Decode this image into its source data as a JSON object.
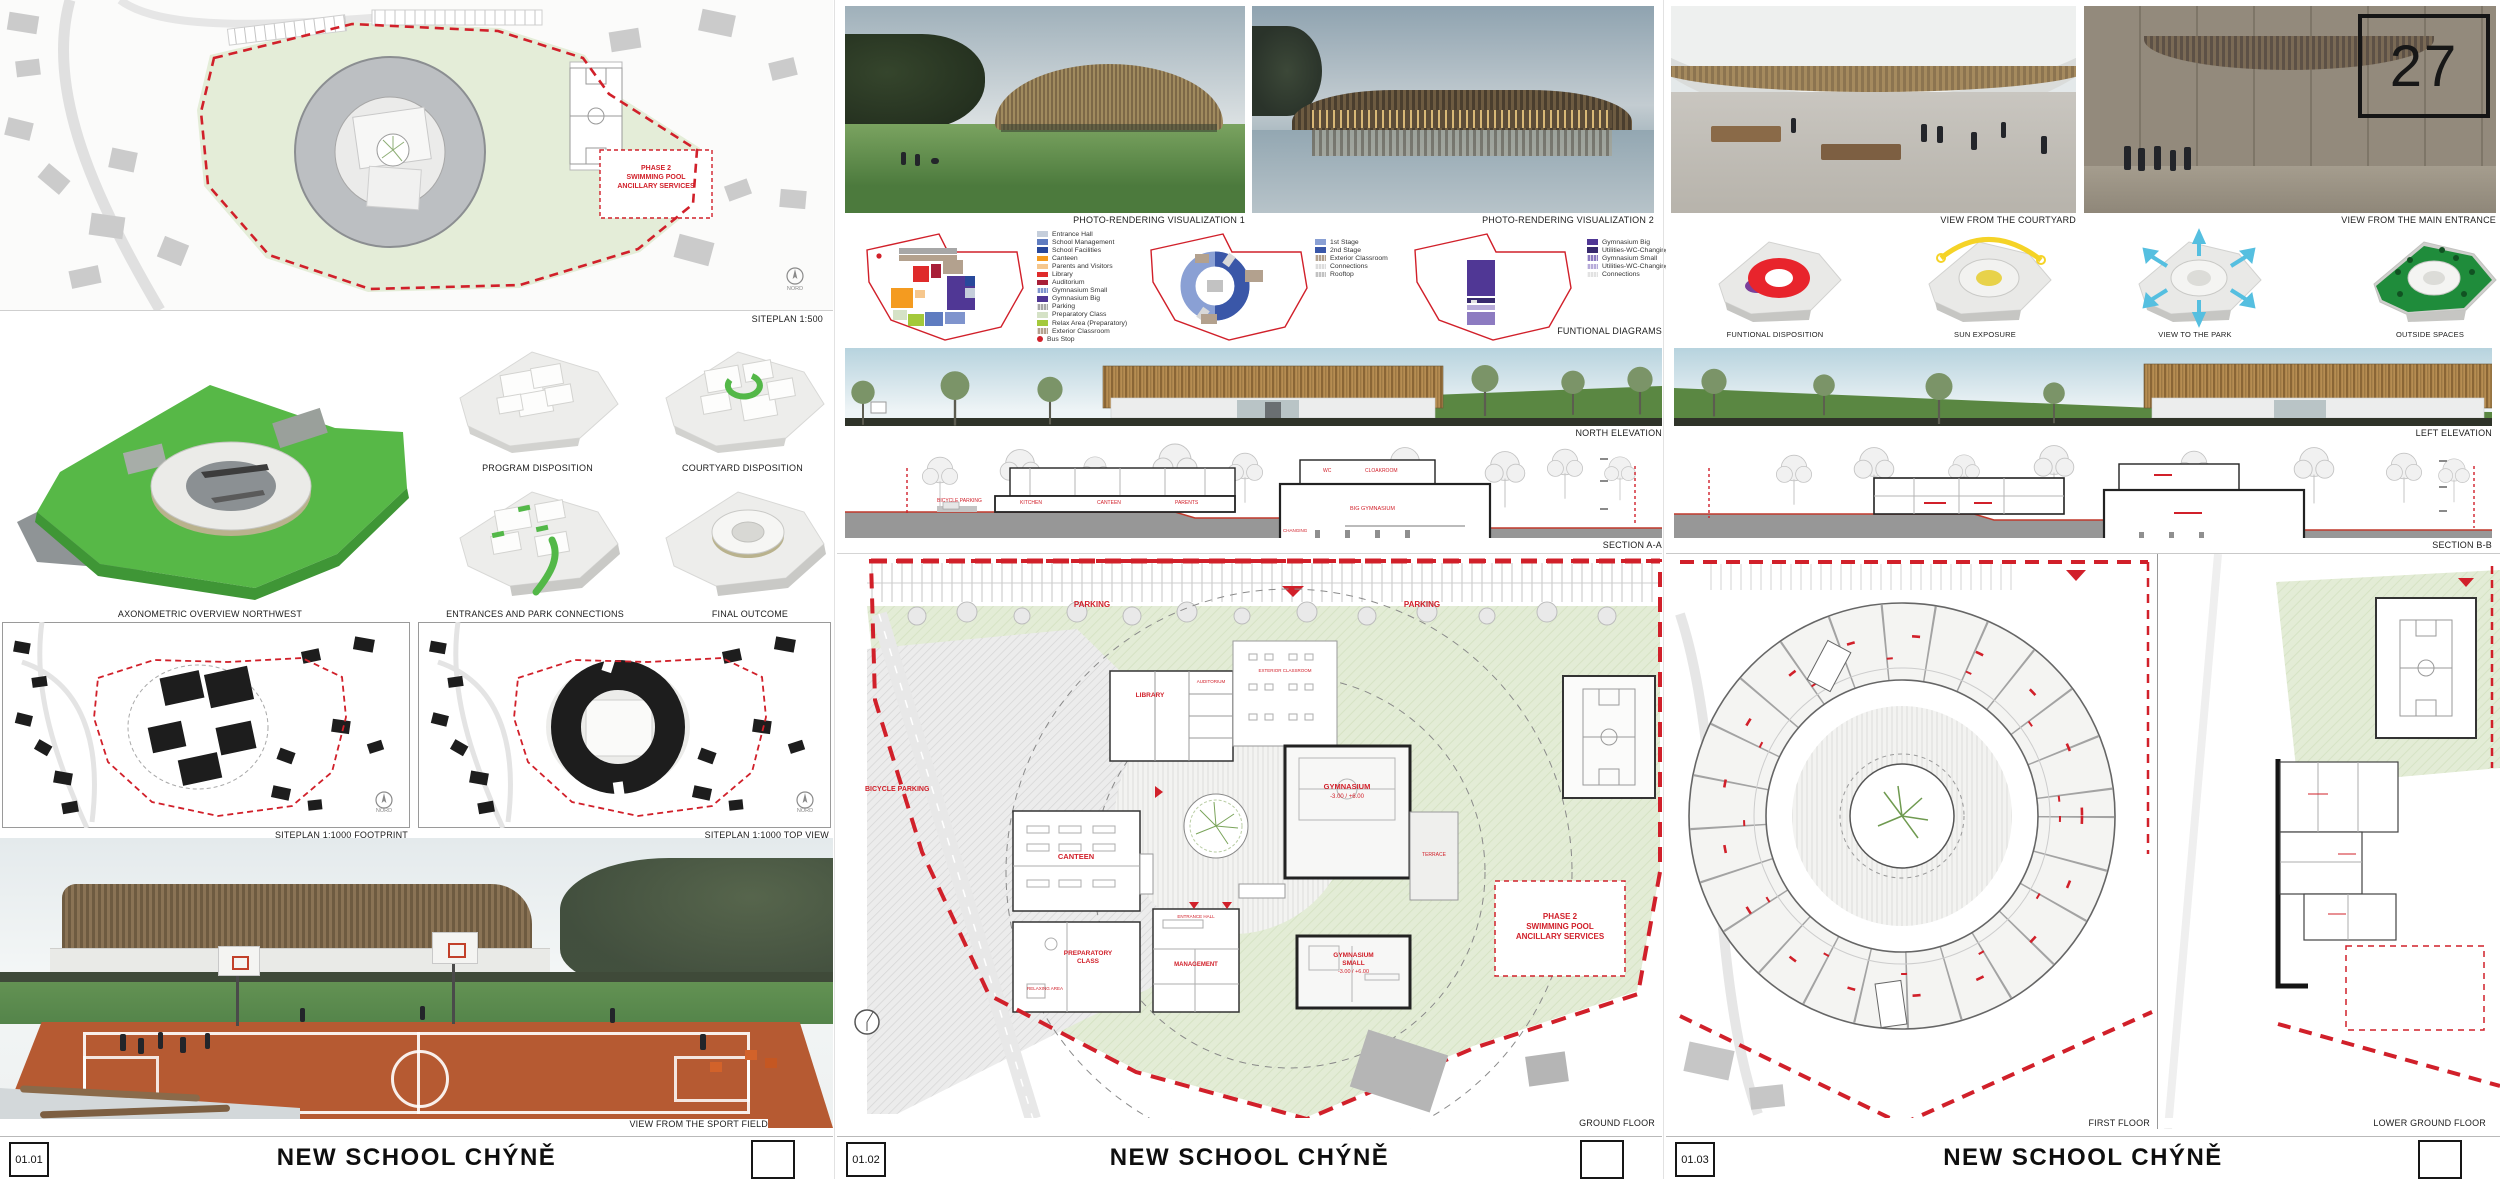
{
  "palette": {
    "red": "#d1202a",
    "site_green": "#e0ead1",
    "axon_green": "#53b848",
    "wood": "#a9854f",
    "sky": "#bdd3dd",
    "black": "#111111"
  },
  "b1": {
    "num": "01.01",
    "title": "NEW SCHOOL CHÝNĚ",
    "cap_siteplan": "SITEPLAN 1:500",
    "nord": "NORD",
    "phase2": "PHASE 2\nSWIMMING POOL\nANCILLARY SERVICES",
    "cap_axon": "AXONOMETRIC OVERVIEW NORTHWEST",
    "cap_program": "PROGRAM DISPOSITION",
    "cap_courtyard": "COURTYARD DISPOSITION",
    "cap_entr": "ENTRANCES AND PARK CONNECTIONS",
    "cap_final": "FINAL OUTCOME",
    "cap_fp": "SITEPLAN 1:1000 FOOTPRINT",
    "cap_tv": "SITEPLAN 1:1000 TOP VIEW",
    "cap_sport": "VIEW FROM THE SPORT FIELD"
  },
  "b2": {
    "num": "01.02",
    "title": "NEW SCHOOL CHÝNĚ",
    "cap_viz1": "PHOTO-RENDERING VISUALIZATION 1",
    "cap_viz2": "PHOTO-RENDERING VISUALIZATION 2",
    "cap_fd": "FUNTIONAL DIAGRAMS",
    "leg1": {
      "items": [
        {
          "label": "Entrance Hall",
          "color": "#c5cedb"
        },
        {
          "label": "School Management",
          "color": "#5f7cc0"
        },
        {
          "label": "School Facilities",
          "color": "#28489b"
        },
        {
          "label": "Canteen",
          "color": "#f49b20"
        },
        {
          "label": "Parents and Visitors",
          "color": "#f6c78d"
        },
        {
          "label": "Library",
          "color": "#df2b2b"
        },
        {
          "label": "Auditorium",
          "color": "#a81f38"
        },
        {
          "label": "Gymnasium Small",
          "color": "#7f94cd"
        },
        {
          "label": "Gymnasium Big",
          "color": "#503795"
        },
        {
          "label": "Parking",
          "color": "#a7a7a7"
        },
        {
          "label": "Preparatory Class",
          "color": "#d5e2c6"
        },
        {
          "label": "Relax Area (Preparatory)",
          "color": "#a4c93b"
        },
        {
          "label": "Exterior Classroom",
          "color": "#b3a18e"
        },
        {
          "label": "Bus Stop",
          "color": "#d1202a"
        }
      ]
    },
    "leg2": {
      "items": [
        {
          "label": "1st Stage",
          "color": "#8aa0d4"
        },
        {
          "label": "2nd Stage",
          "color": "#3a57a8"
        },
        {
          "label": "Exterior Classroom",
          "color": "#b3a18e"
        },
        {
          "label": "Connections",
          "color": "#dcdcdc"
        },
        {
          "label": "Rooftop",
          "color": "#c2c2c2"
        }
      ]
    },
    "leg3": {
      "items": [
        {
          "label": "Gymnasium Big",
          "color": "#503795"
        },
        {
          "label": "Utilities-WC-Changing",
          "color": "#382a6e"
        },
        {
          "label": "Gymnasium Small",
          "color": "#8d7bc1"
        },
        {
          "label": "Utilities-WC-Changing",
          "color": "#b7abd9"
        },
        {
          "label": "Connections",
          "color": "#e2e2e2"
        }
      ]
    },
    "cap_ne": "NORTH ELEVATION",
    "cap_sa": "SECTION A-A",
    "sec": {
      "bicycle": "BICYCLE PARKING",
      "kitchen": "KITCHEN",
      "canteen": "CANTEEN",
      "parents": "PARENTS",
      "wc": "WC",
      "cloak": "CLOAKROOM",
      "biggym": "BIG GYMNASIUM",
      "changing": "CHANGING"
    },
    "gf": {
      "cap": "GROUND FLOOR",
      "parking": "PARKING",
      "bicycle": "BICYCLE PARKING",
      "ext": "EXTERIOR CLASSROOM",
      "library": "LIBRARY",
      "aud": "AUDITORIUM",
      "hall": "ENTRANCE HALL",
      "canteen": "CANTEEN",
      "mgmt": "MANAGEMENT",
      "prep": "PREPARATORY\nCLASS",
      "relax": "RELAXING AREA",
      "gbig": "GYMNASIUM",
      "lvl": "-3.00 / +6.00",
      "gsmall": "GYMNASIUM\nSMALL",
      "terrace": "TERRACE",
      "phase2": "PHASE 2\nSWIMMING POOL\nANCILLARY SERVICES"
    }
  },
  "b3": {
    "num": "01.03",
    "title": "NEW SCHOOL CHÝNĚ",
    "cap_cy": "VIEW FROM THE COURTYARD",
    "cap_me": "VIEW FROM THE MAIN ENTRANCE",
    "badge": "27",
    "d1": "FUNTIONAL DISPOSITION",
    "d2": "SUN EXPOSURE",
    "d3": "VIEW TO THE PARK",
    "d4": "OUTSIDE SPACES",
    "cap_le": "LEFT ELEVATION",
    "cap_sb": "SECTION B-B",
    "cap_ff": "FIRST FLOOR",
    "cap_lg": "LOWER GROUND FLOOR"
  }
}
